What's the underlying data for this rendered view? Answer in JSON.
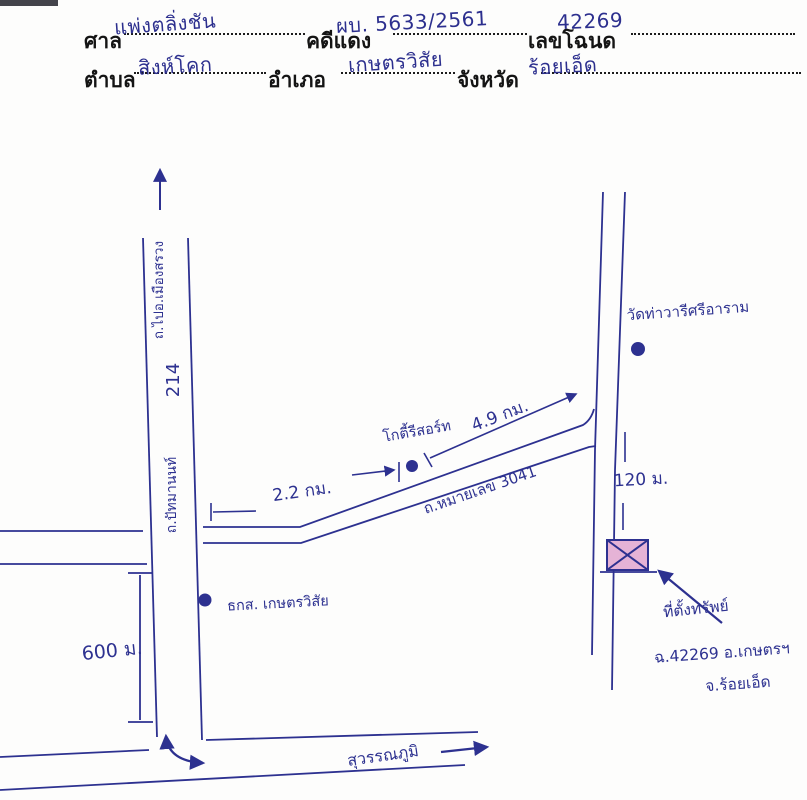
{
  "header": {
    "fields": [
      {
        "label": "ศาล",
        "value": "แพ่งตลิ่งชัน"
      },
      {
        "label": "คดีแดง",
        "value": "ผบ. 5633/2561"
      },
      {
        "label": "เลขโฉนด",
        "value": "42269"
      },
      {
        "label": "ตำบล",
        "value": "สิงห์โคก"
      },
      {
        "label": "อำเภอ",
        "value": "เกษตรวิสัย"
      },
      {
        "label": "จังหวัด",
        "value": "ร้อยเอ็ด"
      }
    ]
  },
  "map": {
    "labels": {
      "road_north": "ถ.ไปอ.เมืองสรวง",
      "route_214": "214",
      "road_214_name": "ถ.ปัทมานนท์",
      "dim_2_2": "2.2 กม.",
      "resort": "โกตี้รีสอร์ท",
      "road_3041": "ถ.หมายเลข 3041",
      "dim_4_9": "4.9 กม.",
      "temple": "วัดท่าวารีศรีอาราม",
      "dim_120": "120 ม.",
      "dim_600": "600 ม.",
      "bank": "ธกส. เกษตรวิสัย",
      "south_road": "สุวรรณภูมิ",
      "plot_caption_line1": "ที่ตั้งทรัพย์",
      "plot_caption_line2": "ฉ.42269 อ.เกษตรฯ",
      "plot_caption_line3": "จ.ร้อยเอ็ด"
    },
    "colors": {
      "ink": "#2d3190",
      "plot_fill": "#e5b3d6",
      "paper": "#fdfdfc"
    }
  }
}
